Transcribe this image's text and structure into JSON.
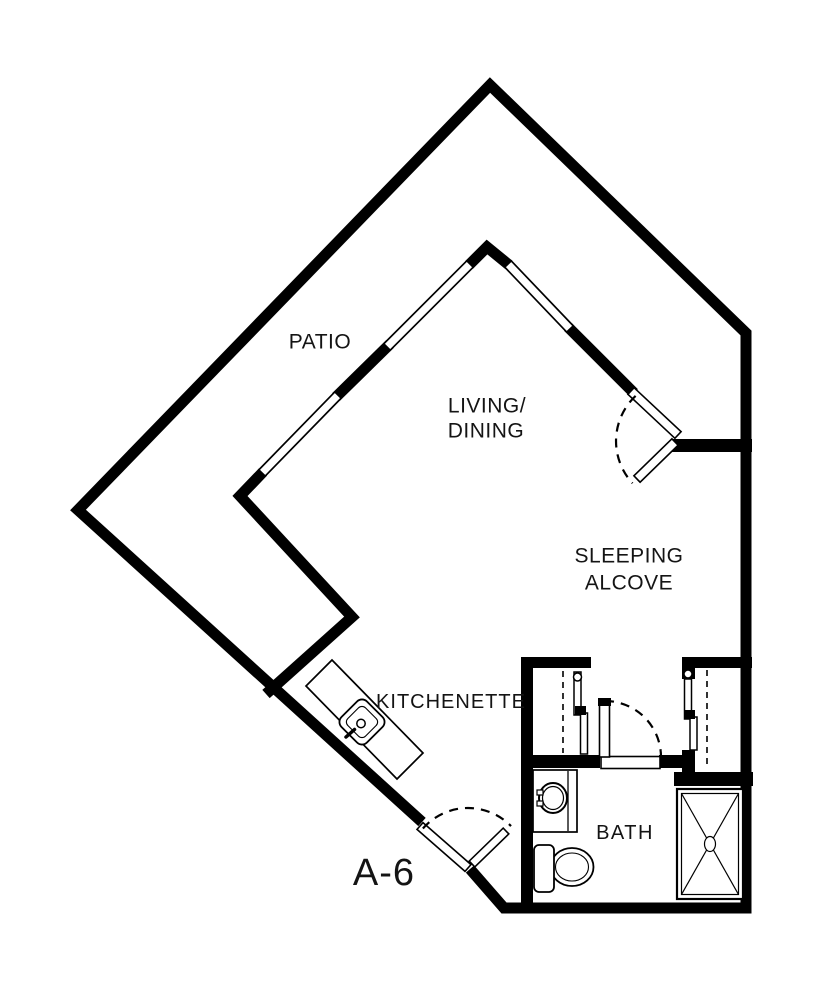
{
  "plan": {
    "unit_label": "A-6",
    "rooms": {
      "patio": "PATIO",
      "living_dining_line1": "LIVING/",
      "living_dining_line2": "DINING",
      "sleeping_alcove_line1": "SLEEPING",
      "sleeping_alcove_line2": "ALCOVE",
      "kitchenette": "KITCHENETTE",
      "bath": "BATH"
    },
    "icons": {
      "kitchen_sink": "kitchen-sink-icon",
      "bathroom_sink": "bathroom-sink-icon",
      "toilet": "toilet-icon",
      "shower": "shower-icon",
      "door_swing": "door-swing-arc",
      "closet_rod": "closet-rod-dashed-line"
    },
    "colors": {
      "wall": "#000000",
      "background": "#ffffff",
      "text": "#141414"
    }
  }
}
